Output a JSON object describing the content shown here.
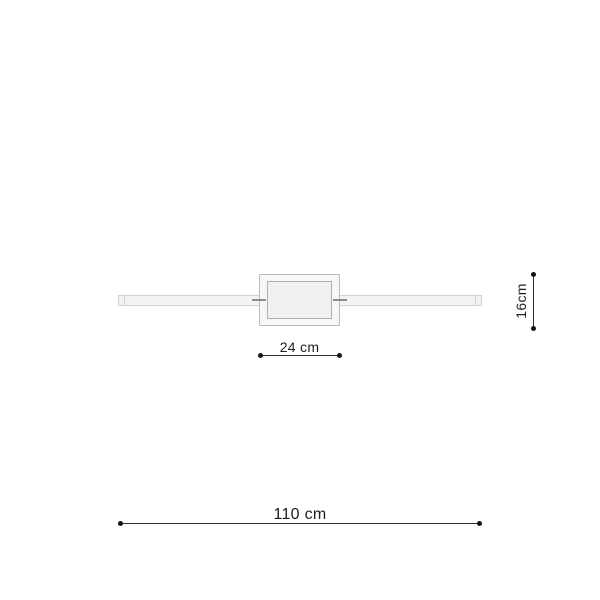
{
  "theme": {
    "bg": "#ffffff",
    "dim-line": "#2e2e2e",
    "dim-dot": "#141414",
    "dim-text": "#1d1d1d",
    "bar-fill": "#f3f3f3",
    "bar-border": "#d3d3d3",
    "box-fill": "#f7f7f7",
    "box-border": "#bcbcbc",
    "inner-fill": "#f0f0f0",
    "inner-border": "#b0b0b0",
    "connector": "#8e8e8e"
  },
  "diagram": {
    "dimensions": {
      "center_width": {
        "label": "24 cm"
      },
      "height": {
        "label": "16cm"
      },
      "total_length": {
        "label": "110 cm"
      }
    }
  }
}
